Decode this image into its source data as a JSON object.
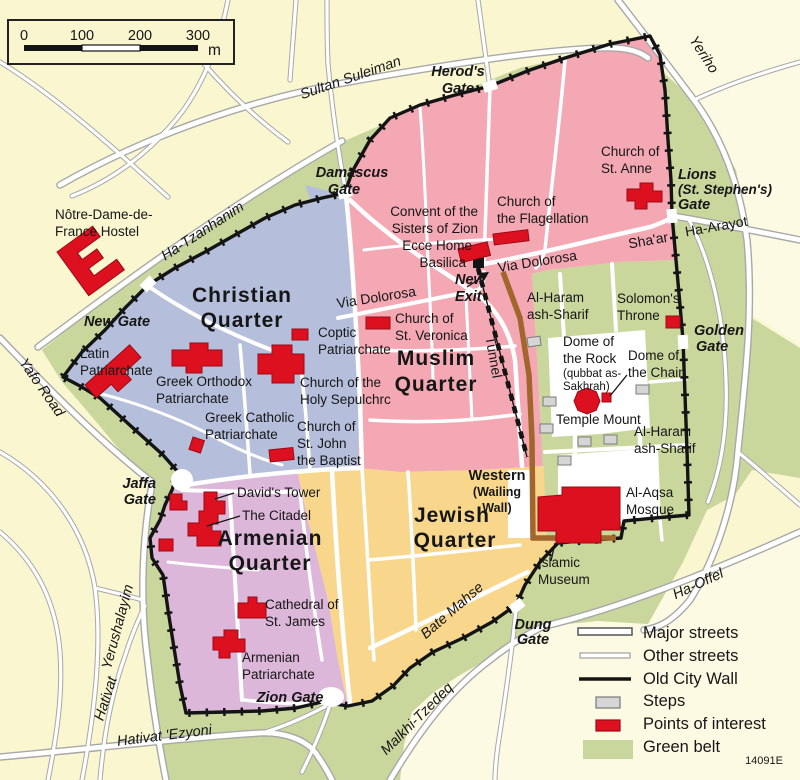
{
  "palette": {
    "background": "#faf6d0",
    "background_light": "#fdfae4",
    "green_belt": "#c9d69c",
    "christian_quarter": "#b5bfdc",
    "muslim_quarter": "#f3a8b4",
    "armenian_quarter": "#ddb7d9",
    "jewish_quarter": "#f8d78d",
    "poi_red": "#dd1020",
    "steps_gray": "#d5d5d5",
    "wall_black": "#141414",
    "western_wall_brown": "#a2652c",
    "label_orange": "#bf7b10"
  },
  "scale_bar": {
    "ticks": [
      "0",
      "100",
      "200",
      "300"
    ],
    "unit": "m"
  },
  "quarters": {
    "christian": {
      "l1": "Christian",
      "l2": "Quarter"
    },
    "muslim": {
      "l1": "Muslim",
      "l2": "Quarter"
    },
    "jewish": {
      "l1": "Jewish",
      "l2": "Quarter"
    },
    "armenian": {
      "l1": "Armenian",
      "l2": "Quarter"
    }
  },
  "gates": {
    "herods": {
      "l1": "Herod's",
      "l2": "Gate"
    },
    "damascus": {
      "l1": "Damascus",
      "l2": "Gate"
    },
    "lions": {
      "l1": "Lions",
      "l2": "(St. Stephen's)",
      "l3": "Gate"
    },
    "new_gate": {
      "l1": "New Gate"
    },
    "golden": {
      "l1": "Golden",
      "l2": "Gate"
    },
    "jaffa": {
      "l1": "Jaffa",
      "l2": "Gate"
    },
    "zion": {
      "l1": "Zion Gate"
    },
    "dung": {
      "l1": "Dung",
      "l2": "Gate"
    }
  },
  "streets": {
    "sultan_suleiman": "Sultan Suleiman",
    "yeriho": "Yeriho",
    "ha_tzanhanim": "Ha-Tzanhanim",
    "yafo_road": "Yafo Road",
    "yerushalayim": "Yerushalayim",
    "hativat": "Hativat",
    "hativat_ezyoni": "Hativat 'Ezyoni",
    "malkhi_tzedeq": "Malkhi-Tzedeq",
    "bate_mahse": "Bate  Mahse",
    "ha_offel": "Ha-Offel",
    "via_dolorosa_west": "Via Dolorosa",
    "via_dolorosa_east": "Via Dolorosa",
    "shaar": "Sha'ar",
    "ha_arayot": "Ha-Arayot",
    "tunnel": "Tunnel"
  },
  "pois": {
    "notre_dame": {
      "l1": "Nôtre-Dame-de-",
      "l2": "France Hostel"
    },
    "latin_patriarchate": {
      "l1": "Latin",
      "l2": "Patriarchate"
    },
    "greek_orthodox": {
      "l1": "Greek Orthodox",
      "l2": "Patriarchate"
    },
    "coptic": {
      "l1": "Coptic",
      "l2": "Patriarchate"
    },
    "st_veronica": {
      "l1": "Church of",
      "l2": "St. Veronica"
    },
    "holy_sepulchre": {
      "l1": "Church of the",
      "l2": "Holy Sepulchrc"
    },
    "greek_catholic": {
      "l1": "Greek Catholic",
      "l2": "Patriarchate"
    },
    "st_john": {
      "l1": "Church of",
      "l2": "St. John",
      "l3": "the Baptist"
    },
    "convent_sisters": {
      "l1": "Convent of the",
      "l2": "Sisters of Zion",
      "l3": "Ecce Home",
      "l4": "Basilica"
    },
    "flagellation": {
      "l1": "Church of",
      "l2": "the Flagellation"
    },
    "st_anne": {
      "l1": "Church of",
      "l2": "St. Anne"
    },
    "new_exit": {
      "l1": "New",
      "l2": "Exit"
    },
    "al_haram_north": {
      "l1": "Al-Haram",
      "l2": "ash-Sharif"
    },
    "solomons_throne": {
      "l1": "Solomon's",
      "l2": "Throne"
    },
    "dome_of_rock": {
      "l1": "Dome of",
      "l2": "the Rock",
      "l3": "(qubbat as-",
      "l4": "Sakhrah)"
    },
    "dome_of_chain": {
      "l1": "Dome of",
      "l2": "the Chain"
    },
    "temple_mount": {
      "l1": "Temple Mount"
    },
    "al_haram_south": {
      "l1": "Al-Haram",
      "l2": "ash-Sharif"
    },
    "al_aqsa": {
      "l1": "Al-Aqsa",
      "l2": "Mosque"
    },
    "islamic_museum": {
      "l1": "Islamic",
      "l2": "Museum"
    },
    "western_wall": {
      "l1": "Western",
      "l2": "(Wailing",
      "l3": "Wall)"
    },
    "davids_tower": {
      "l1": "David's Tower"
    },
    "citadel": {
      "l1": "The Citadel"
    },
    "st_james": {
      "l1": "Cathedral of",
      "l2": "St. James"
    },
    "armenian_patriarchate": {
      "l1": "Armenian",
      "l2": "Patriarchate"
    }
  },
  "legend": {
    "major_streets": "Major streets",
    "other_streets": "Other streets",
    "old_city_wall": "Old City Wall",
    "steps": "Steps",
    "points_of_interest": "Points of interest",
    "green_belt": "Green belt",
    "map_code": "14091E"
  }
}
